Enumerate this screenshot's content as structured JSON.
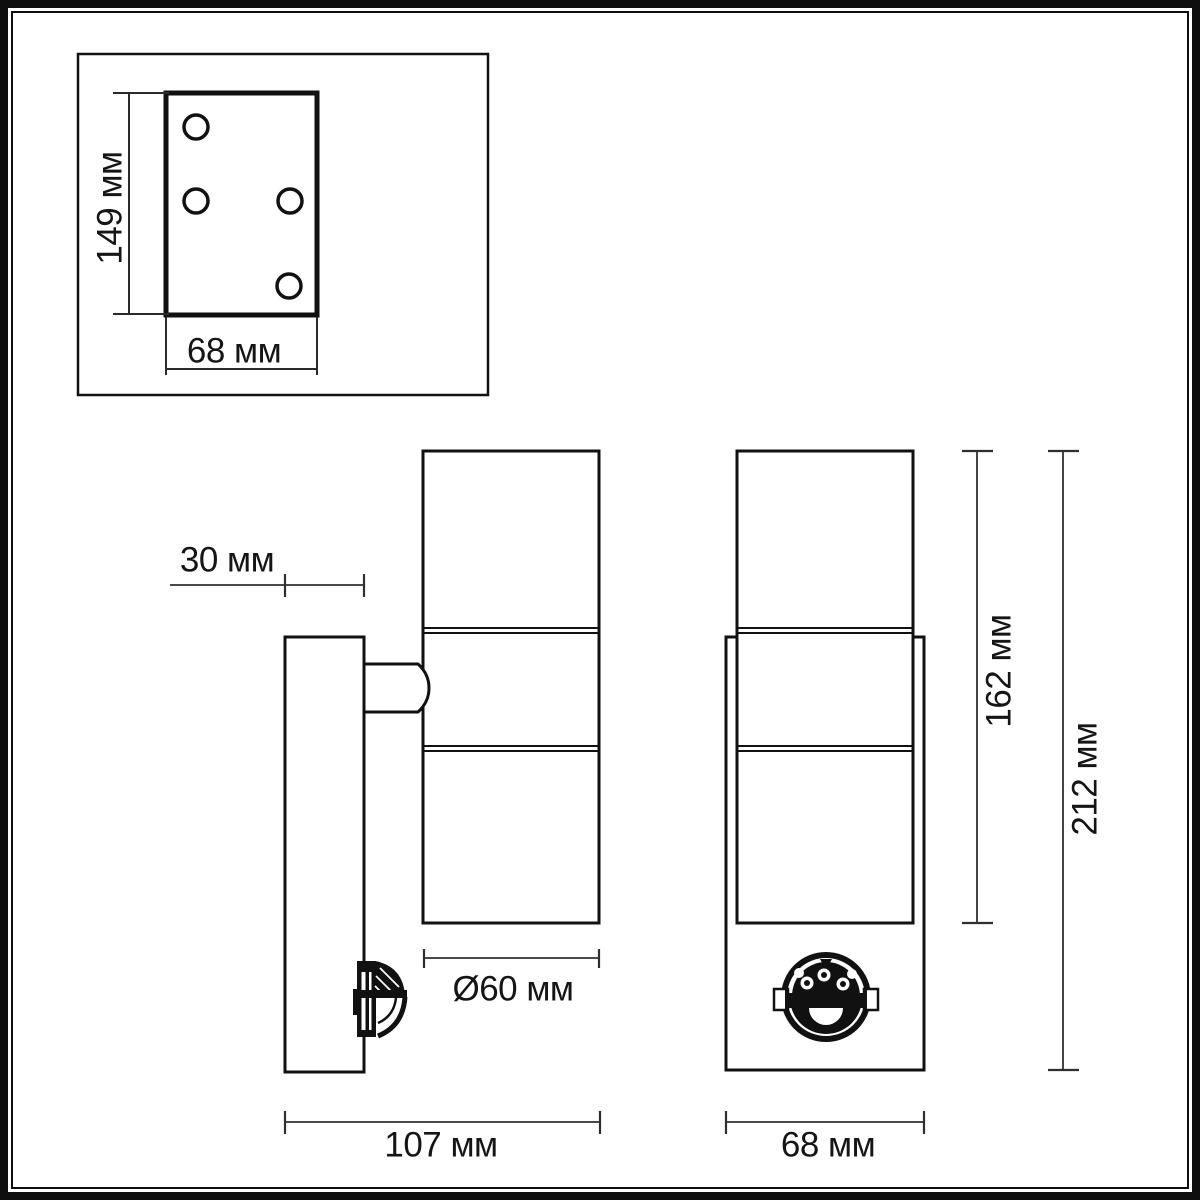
{
  "drawing": {
    "colors": {
      "background": "#ffffff",
      "ink": "#111111",
      "dimension_lines": "#2f2f2f",
      "text": "#151515"
    },
    "dimensions": {
      "plate_height": {
        "label": "149 мм",
        "value_mm": 149
      },
      "plate_width": {
        "label": "68 мм",
        "value_mm": 68
      },
      "wall_offset": {
        "label": "30 мм",
        "value_mm": 30
      },
      "body_diameter": {
        "label": "Ø60 мм",
        "value_mm": 60
      },
      "side_total_width": {
        "label": "107 мм",
        "value_mm": 107
      },
      "front_width": {
        "label": "68 мм",
        "value_mm": 68
      },
      "body_height": {
        "label": "162 мм",
        "value_mm": 162
      },
      "total_height": {
        "label": "212 мм",
        "value_mm": 212
      }
    },
    "mounting_plate": {
      "screw_hole_count": 4
    }
  }
}
